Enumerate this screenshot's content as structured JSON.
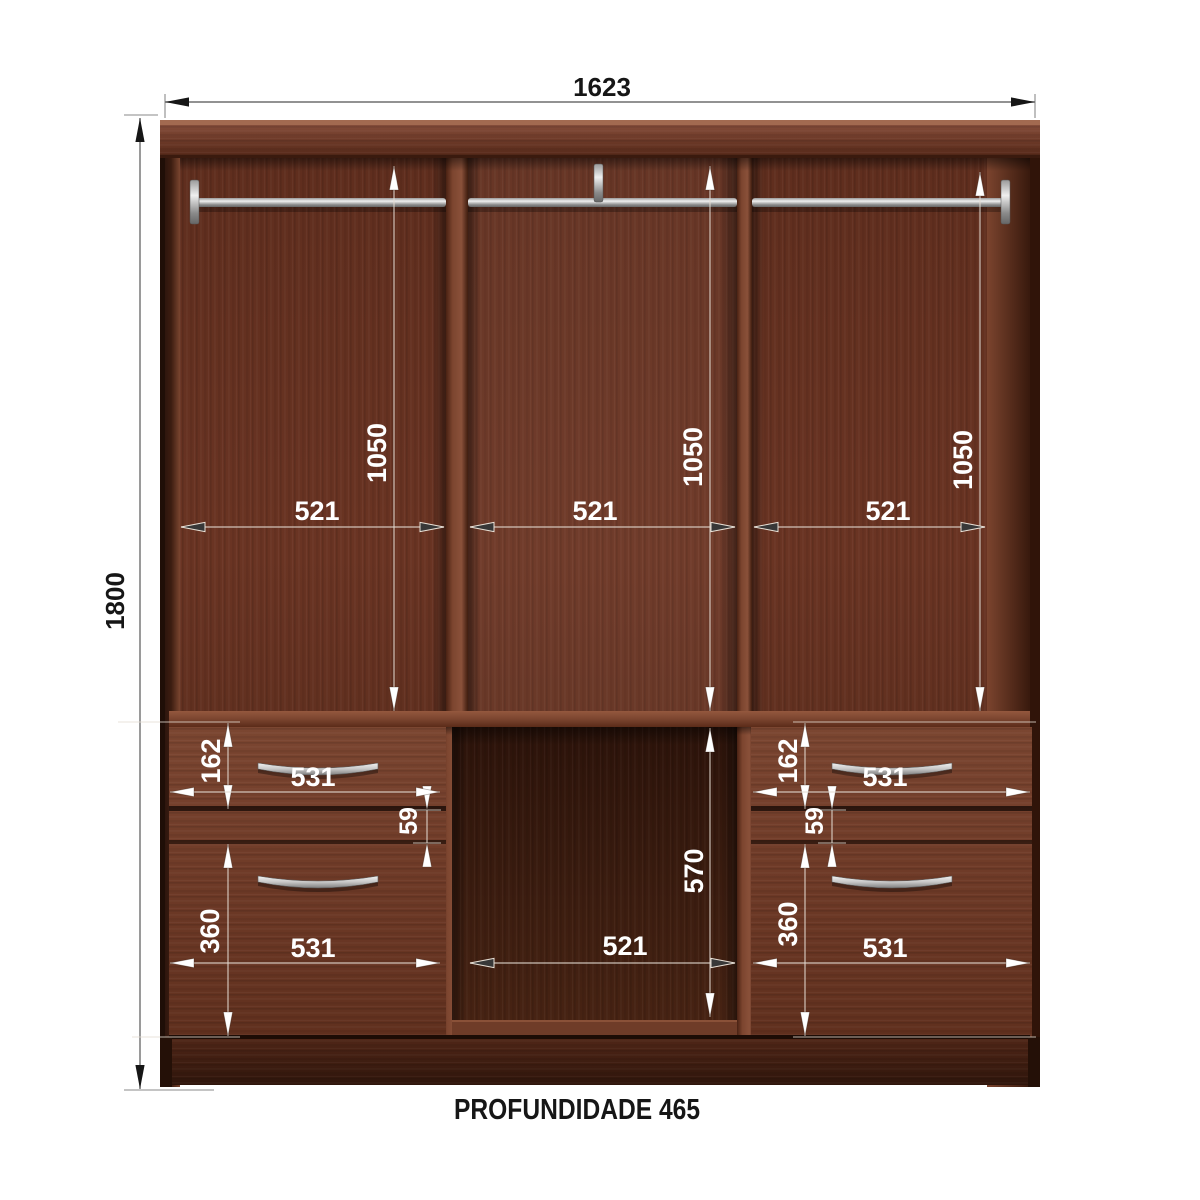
{
  "diagram": {
    "kind": "wardrobe-internal-dimensions",
    "units_shown": "mm-values-only"
  },
  "annotations": {
    "overall_width": "1623",
    "overall_height": "1800",
    "hanging_height_left": "1050",
    "hanging_height_middle": "1050",
    "hanging_height_right": "1050",
    "inner_width_left": "521",
    "inner_width_middle": "521",
    "inner_width_right": "521",
    "top_drawer_height_left": "162",
    "top_drawer_height_right": "162",
    "drawer_gap_left": "59",
    "drawer_gap_right": "59",
    "bottom_drawer_height_left": "360",
    "bottom_drawer_height_right": "360",
    "drawer_width_top_left": "531",
    "drawer_width_bottom_left": "531",
    "drawer_width_top_right": "531",
    "drawer_width_bottom_right": "531",
    "open_compartment_height": "570",
    "open_compartment_width": "521",
    "depth": "PROFUNDIDADE 465"
  },
  "colors": {
    "background": "#ffffff",
    "wood_medium": "#6e3a27",
    "wood_light": "#8a5138",
    "wood_dark": "#3c1d10",
    "open_compartment": "#331709",
    "metal": "#c9c9c9",
    "dim_text_inside": "#ffffff",
    "dim_text_outside": "#1a1a1a",
    "dim_line": "#8a8a8a"
  }
}
